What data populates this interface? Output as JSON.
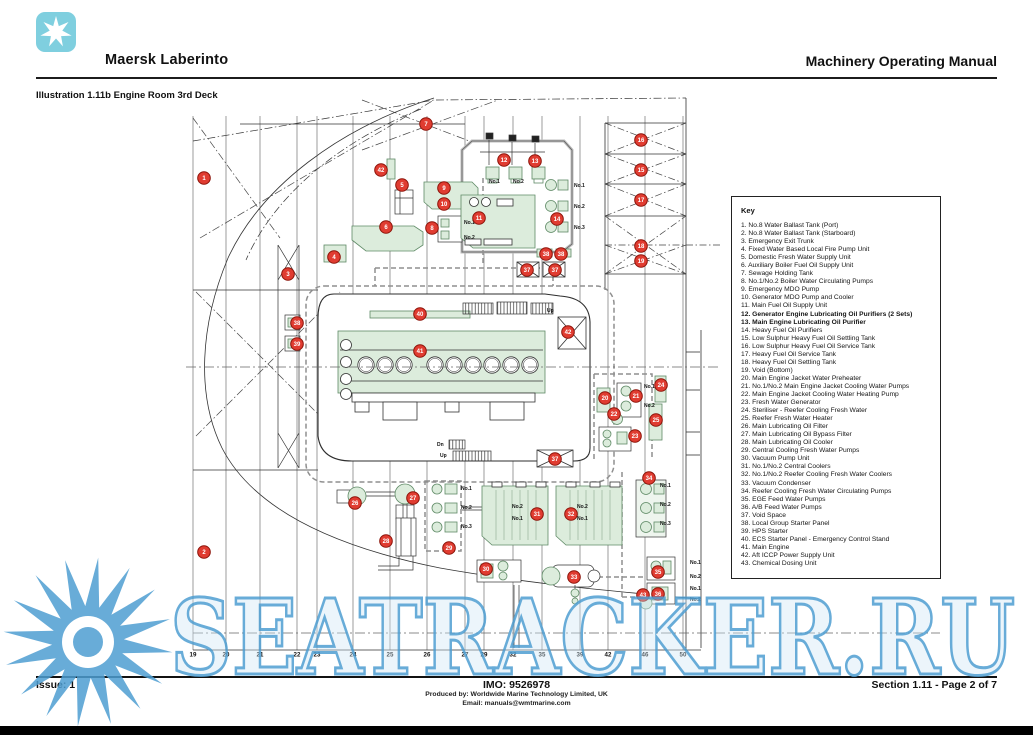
{
  "header": {
    "ship_name": "Maersk Laberinto",
    "manual_title": "Machinery Operating Manual",
    "logo_color": "#7fcfdf"
  },
  "illustration": {
    "title": "Illustration 1.11b Engine Room 3rd Deck"
  },
  "key": {
    "title": "Key",
    "items": [
      {
        "n": "1",
        "label": "No.8 Water Ballast Tank (Port)"
      },
      {
        "n": "2",
        "label": "No.8 Water Ballast Tank (Starboard)"
      },
      {
        "n": "3",
        "label": "Emergency Exit Trunk"
      },
      {
        "n": "4",
        "label": "Fixed Water Based Local Fire Pump Unit"
      },
      {
        "n": "5",
        "label": "Domestic Fresh Water Supply Unit"
      },
      {
        "n": "6",
        "label": "Auxiliary Boiler Fuel Oil Supply Unit"
      },
      {
        "n": "7",
        "label": "Sewage Holding Tank"
      },
      {
        "n": "8",
        "label": "No.1/No.2 Boiler Water Circulating Pumps"
      },
      {
        "n": "9",
        "label": "Emergency MDO Pump"
      },
      {
        "n": "10",
        "label": "Generator MDO Pump and Cooler"
      },
      {
        "n": "11",
        "label": "Main Fuel Oil Supply Unit"
      },
      {
        "n": "12",
        "label": "Generator Engine Lubricating Oil Purifiers (2 Sets)",
        "bold": true
      },
      {
        "n": "13",
        "label": "Main Engine Lubricating Oil Purifier",
        "bold": true
      },
      {
        "n": "14",
        "label": "Heavy Fuel Oil Purifiers"
      },
      {
        "n": "15",
        "label": "Low Sulphur Heavy Fuel Oil Settling Tank"
      },
      {
        "n": "16",
        "label": "Low Sulphur Heavy Fuel Oil Service Tank"
      },
      {
        "n": "17",
        "label": "Heavy Fuel Oil Service Tank"
      },
      {
        "n": "18",
        "label": "Heavy Fuel Oil Settling Tank"
      },
      {
        "n": "19",
        "label": "Void (Bottom)"
      },
      {
        "n": "20",
        "label": "Main Engine Jacket Water Preheater"
      },
      {
        "n": "21",
        "label": "No.1/No.2 Main Engine Jacket Cooling Water Pumps"
      },
      {
        "n": "22",
        "label": "Main Engine Jacket Cooling Water Heating Pump"
      },
      {
        "n": "23",
        "label": "Fresh Water Generator"
      },
      {
        "n": "24",
        "label": "Steriliser - Reefer Cooling Fresh Water"
      },
      {
        "n": "25",
        "label": "Reefer Fresh Water Heater"
      },
      {
        "n": "26",
        "label": "Main Lubricating Oil Filter"
      },
      {
        "n": "27",
        "label": "Main Lubricating Oil Bypass Filter"
      },
      {
        "n": "28",
        "label": "Main Lubricating Oil Cooler"
      },
      {
        "n": "29",
        "label": "Central Cooling Fresh Water Pumps"
      },
      {
        "n": "30",
        "label": "Vacuum Pump Unit"
      },
      {
        "n": "31",
        "label": "No.1/No.2 Central Coolers"
      },
      {
        "n": "32",
        "label": "No.1/No.2 Reefer Cooling Fresh Water Coolers"
      },
      {
        "n": "33",
        "label": "Vacuum Condenser"
      },
      {
        "n": "34",
        "label": "Reefer Cooling Fresh Water Circulating Pumps"
      },
      {
        "n": "35",
        "label": "EGE Feed Water Pumps"
      },
      {
        "n": "36",
        "label": "A/B Feed Water Pumps"
      },
      {
        "n": "37",
        "label": "Void Space"
      },
      {
        "n": "38",
        "label": "Local Group Starter Panel"
      },
      {
        "n": "39",
        "label": "HPS Starter"
      },
      {
        "n": "40",
        "label": "ECS Starter Panel - Emergency Control Stand"
      },
      {
        "n": "41",
        "label": "Main Engine"
      },
      {
        "n": "42",
        "label": "Aft ICCP Power Supply Unit"
      },
      {
        "n": "43",
        "label": "Chemical Dosing Unit"
      }
    ]
  },
  "diagram": {
    "colors": {
      "equipment_green": "#dcecdc",
      "equipment_border": "#5f8a66",
      "marker_red": "#e03c31",
      "marker_border": "#8c1309",
      "line": "#333333",
      "dashed_gray": "#8f8f8f",
      "watermark_blue": "#4e9ed2"
    },
    "frame_numbers": [
      {
        "x": 193,
        "label": "19"
      },
      {
        "x": 226,
        "label": "20"
      },
      {
        "x": 260,
        "label": "21"
      },
      {
        "x": 297,
        "label": "22"
      },
      {
        "x": 317,
        "label": "23"
      },
      {
        "x": 353,
        "label": "24"
      },
      {
        "x": 390,
        "label": "25"
      },
      {
        "x": 427,
        "label": "26"
      },
      {
        "x": 465,
        "label": "27"
      },
      {
        "x": 484,
        "label": "29"
      },
      {
        "x": 513,
        "label": "32"
      },
      {
        "x": 542,
        "label": "35"
      },
      {
        "x": 580,
        "label": "39"
      },
      {
        "x": 608,
        "label": "42"
      },
      {
        "x": 645,
        "label": "46"
      },
      {
        "x": 683,
        "label": "50"
      }
    ],
    "labels": [
      {
        "t": "No.1",
        "x": 489,
        "y": 183
      },
      {
        "t": "No.2",
        "x": 513,
        "y": 183
      },
      {
        "t": "No.1",
        "x": 574,
        "y": 187
      },
      {
        "t": "No.2",
        "x": 574,
        "y": 208
      },
      {
        "t": "No.3",
        "x": 574,
        "y": 229
      },
      {
        "t": "No.1",
        "x": 464,
        "y": 224
      },
      {
        "t": "No.2",
        "x": 464,
        "y": 239
      },
      {
        "t": "No.1",
        "x": 644,
        "y": 388
      },
      {
        "t": "No.2",
        "x": 644,
        "y": 407
      },
      {
        "t": "No.1",
        "x": 660,
        "y": 487
      },
      {
        "t": "No.2",
        "x": 660,
        "y": 506
      },
      {
        "t": "No.3",
        "x": 660,
        "y": 525
      },
      {
        "t": "No.1",
        "x": 690,
        "y": 564
      },
      {
        "t": "No.2",
        "x": 690,
        "y": 578
      },
      {
        "t": "No.1",
        "x": 690,
        "y": 590
      },
      {
        "t": "No.2",
        "x": 690,
        "y": 601
      },
      {
        "t": "No.1",
        "x": 461,
        "y": 490
      },
      {
        "t": "No.2",
        "x": 461,
        "y": 509
      },
      {
        "t": "No.3",
        "x": 461,
        "y": 528
      },
      {
        "t": "No.2",
        "x": 512,
        "y": 508
      },
      {
        "t": "No.1",
        "x": 512,
        "y": 520
      },
      {
        "t": "No.2",
        "x": 577,
        "y": 508
      },
      {
        "t": "No.1",
        "x": 577,
        "y": 520
      },
      {
        "t": "Up",
        "x": 547,
        "y": 312
      },
      {
        "t": "Dn",
        "x": 437,
        "y": 446
      },
      {
        "t": "Up",
        "x": 440,
        "y": 457
      }
    ],
    "markers": [
      {
        "n": "1",
        "x": 204,
        "y": 178
      },
      {
        "n": "2",
        "x": 204,
        "y": 552
      },
      {
        "n": "3",
        "x": 288,
        "y": 274
      },
      {
        "n": "4",
        "x": 334,
        "y": 257
      },
      {
        "n": "5",
        "x": 402,
        "y": 185
      },
      {
        "n": "6",
        "x": 386,
        "y": 227
      },
      {
        "n": "7",
        "x": 426,
        "y": 124
      },
      {
        "n": "8",
        "x": 432,
        "y": 228
      },
      {
        "n": "9",
        "x": 444,
        "y": 188
      },
      {
        "n": "10",
        "x": 444,
        "y": 204
      },
      {
        "n": "11",
        "x": 479,
        "y": 218
      },
      {
        "n": "12",
        "x": 504,
        "y": 160
      },
      {
        "n": "13",
        "x": 535,
        "y": 161
      },
      {
        "n": "14",
        "x": 557,
        "y": 219
      },
      {
        "n": "42",
        "x": 381,
        "y": 170
      },
      {
        "n": "16",
        "x": 641,
        "y": 140
      },
      {
        "n": "15",
        "x": 641,
        "y": 170
      },
      {
        "n": "17",
        "x": 641,
        "y": 200
      },
      {
        "n": "18",
        "x": 641,
        "y": 246
      },
      {
        "n": "19",
        "x": 641,
        "y": 261
      },
      {
        "n": "38",
        "x": 546,
        "y": 254
      },
      {
        "n": "38",
        "x": 561,
        "y": 254
      },
      {
        "n": "37",
        "x": 527,
        "y": 270
      },
      {
        "n": "37",
        "x": 555,
        "y": 270
      },
      {
        "n": "38",
        "x": 297,
        "y": 323
      },
      {
        "n": "39",
        "x": 297,
        "y": 344
      },
      {
        "n": "40",
        "x": 420,
        "y": 314
      },
      {
        "n": "41",
        "x": 420,
        "y": 351
      },
      {
        "n": "42",
        "x": 568,
        "y": 332
      },
      {
        "n": "37",
        "x": 555,
        "y": 459
      },
      {
        "n": "20",
        "x": 605,
        "y": 398
      },
      {
        "n": "21",
        "x": 636,
        "y": 396
      },
      {
        "n": "22",
        "x": 614,
        "y": 414
      },
      {
        "n": "23",
        "x": 635,
        "y": 436
      },
      {
        "n": "24",
        "x": 661,
        "y": 385
      },
      {
        "n": "25",
        "x": 656,
        "y": 420
      },
      {
        "n": "26",
        "x": 355,
        "y": 503
      },
      {
        "n": "27",
        "x": 413,
        "y": 498
      },
      {
        "n": "28",
        "x": 386,
        "y": 541
      },
      {
        "n": "29",
        "x": 449,
        "y": 548
      },
      {
        "n": "30",
        "x": 486,
        "y": 569
      },
      {
        "n": "31",
        "x": 537,
        "y": 514
      },
      {
        "n": "32",
        "x": 571,
        "y": 514
      },
      {
        "n": "33",
        "x": 574,
        "y": 577
      },
      {
        "n": "34",
        "x": 649,
        "y": 478
      },
      {
        "n": "35",
        "x": 658,
        "y": 572
      },
      {
        "n": "36",
        "x": 658,
        "y": 594
      },
      {
        "n": "43",
        "x": 643,
        "y": 595
      }
    ]
  },
  "watermark": {
    "text": "SEATRACKER.RU"
  },
  "footer": {
    "issue": "Issue: 1",
    "imo": "IMO: 9526978",
    "produced_by": "Produced by: Worldwide Marine Technology Limited, UK",
    "email": "Email: manuals@wmtmarine.com",
    "section": "Section 1.11 - Page 2 of 7"
  }
}
